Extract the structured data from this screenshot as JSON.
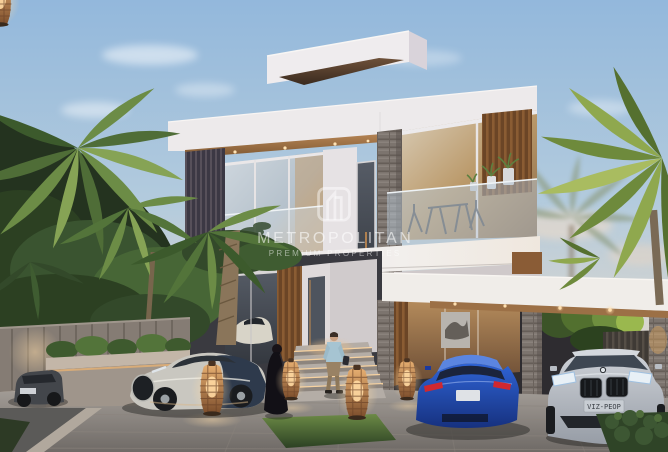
{
  "page": {
    "title": "Luxury villa exterior rendering at dusk",
    "type": "architectural-rendering",
    "time_of_day": "dusk"
  },
  "watermark": {
    "title": "METROPOLITAN",
    "subtitle": "PREMIUM PROPERTIES",
    "logo": "building-outline-logo",
    "color": "#ffffff"
  },
  "scene": {
    "description": "Modern two-storey white villa with glass facades, timber louvres and grey stone columns; paved driveway with luxury cars, palm trees, timber fence, stone planter, glowing wicker lanterns and two people near the entrance steps",
    "building": {
      "style": "modern cubic villa",
      "materials": [
        "white render",
        "glass",
        "timber louvres",
        "grey stone"
      ],
      "features": [
        "roof terrace box",
        "balcony with glass railing",
        "outdoor dining set",
        "potted plants",
        "carport canopy with downlights",
        "entry steps with strip lighting",
        "wall artwork behind glass"
      ]
    },
    "vehicles": {
      "supercar": "two-tone silver and navy supercar, side view",
      "blue_coupe": "blue sports coupe, rear view",
      "silver_coupe": "silver coupe, front view",
      "dark_hatchback": "dark grey car behind planter",
      "silver_coupe_plate": "VIZ-PEOP"
    },
    "people": [
      "woman in black abaya",
      "man in light blue shirt and beige trousers"
    ],
    "landscape": [
      "palm trees",
      "timber slat fence",
      "stone planter with shrubs",
      "clipped lawn",
      "hedge",
      "wicker floor lanterns",
      "road and curb"
    ]
  },
  "palette": {
    "sky_top": "#93b8dc",
    "sky_horizon": "#ecd9c6",
    "building_white": "#efecec",
    "timber": "#a97c52",
    "stone": "#7c746e",
    "glass_cool": "#b9c6d2",
    "glass_warm": "#c29a6a",
    "palm_green": "#6c8c46",
    "driveway": "#a6a09a",
    "lantern_glow": "#e8b072",
    "car_blue": "#2253c6",
    "car_silver": "#b7bcc3",
    "car_cream": "#c9c7c0"
  }
}
